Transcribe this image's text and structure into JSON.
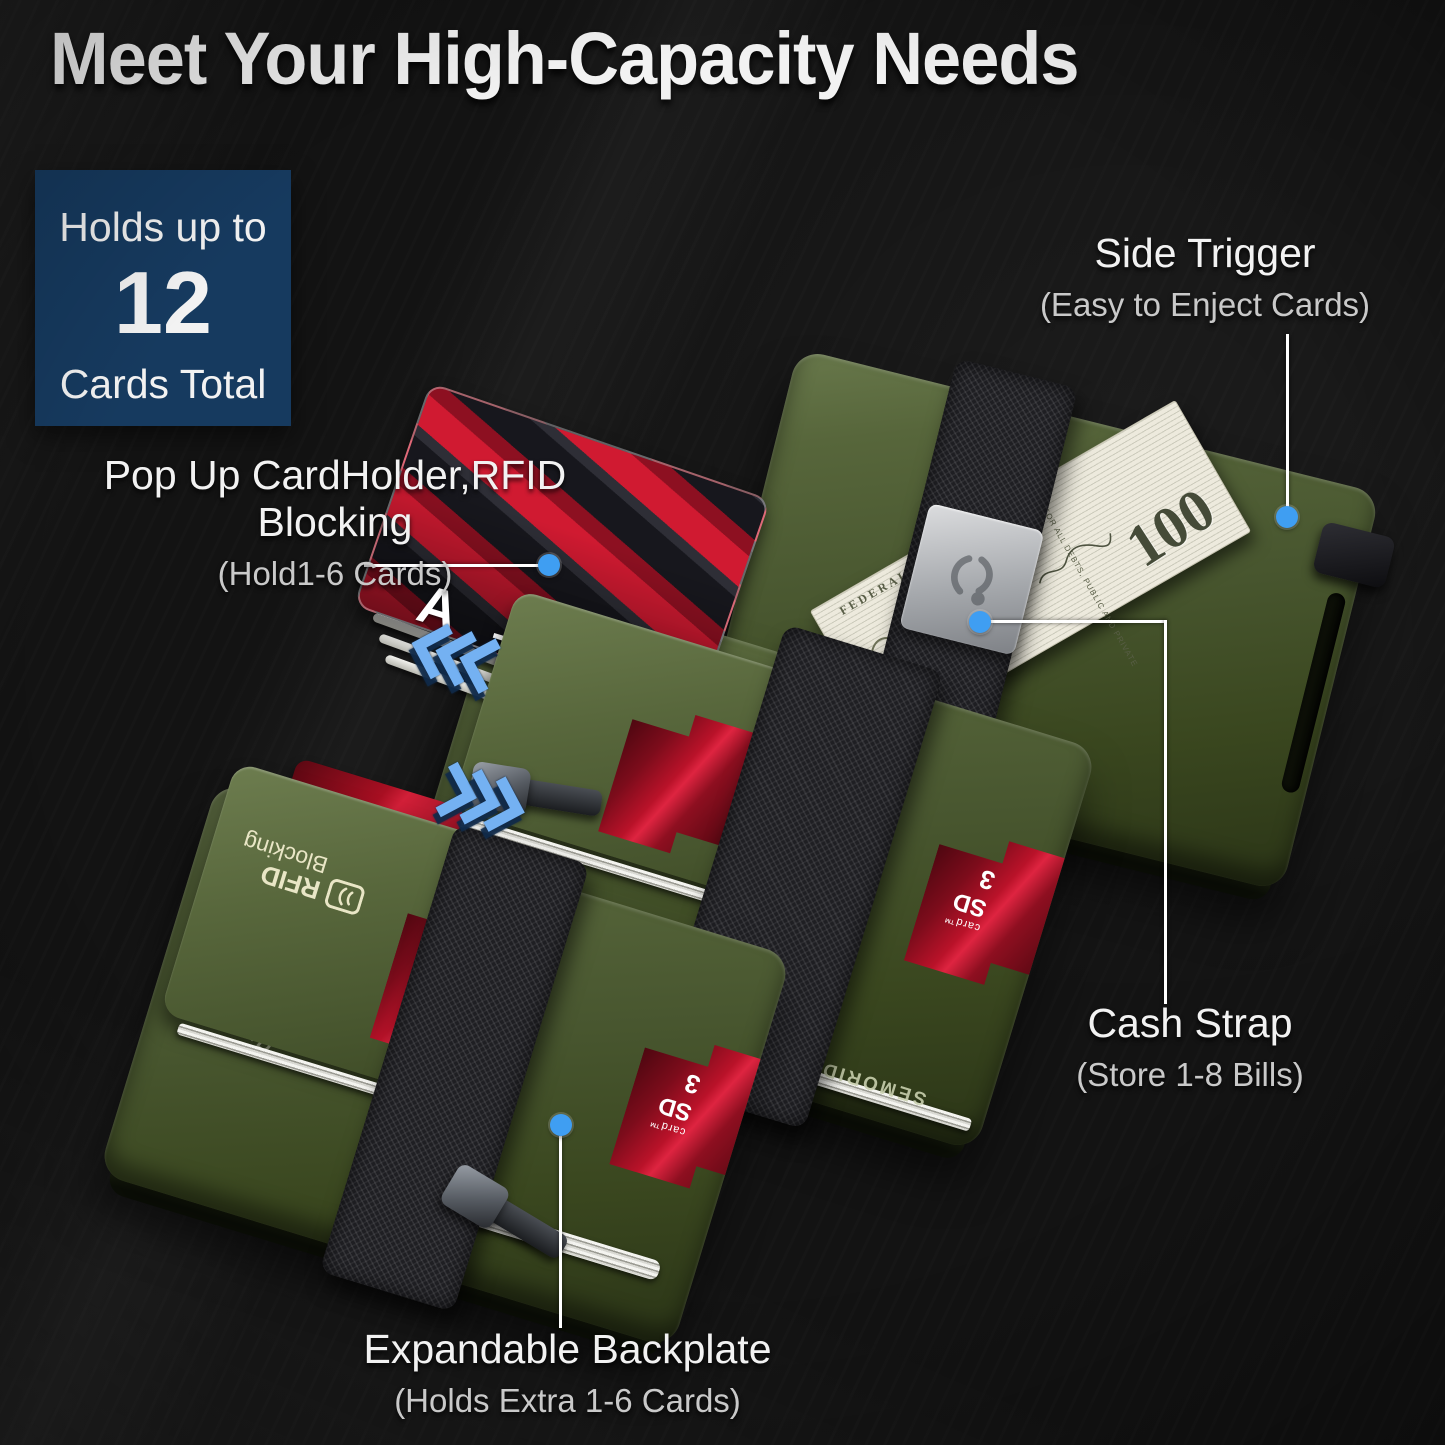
{
  "title": "Meet Your High-Capacity Needs",
  "badge": {
    "line1": "Holds up to",
    "number": "12",
    "line2": "Cards Total"
  },
  "callouts": {
    "popup": {
      "title": "Pop Up CardHolder,RFID Blocking",
      "subtitle": "(Hold1-6 Cards)"
    },
    "side_trigger": {
      "title": "Side Trigger",
      "subtitle": "(Easy to Enject Cards)"
    },
    "cash_strap": {
      "title": "Cash Strap",
      "subtitle": "(Store 1-8 Bills)"
    },
    "backplate": {
      "title": "Expandable Backplate",
      "subtitle": "(Holds Extra 1-6 Cards)"
    }
  },
  "product": {
    "brand": "SEMORID",
    "rfid_print": {
      "line1": "RFID",
      "line2": "Blocking"
    },
    "sd_card": {
      "suffix": "card",
      "brand": "SD",
      "tm": "™",
      "number": "3"
    },
    "bill": {
      "denomination": "100",
      "series_text": "FEDERAL RESERVE NOTE",
      "motto_text": "FOR ALL DEBTS, PUBLIC AND PRIVATE"
    },
    "fan_letters": [
      "A",
      "T",
      "A"
    ]
  },
  "colors": {
    "background": "#131313",
    "badge_bg": "#163a5f",
    "accent_blue": "#3f9ef2",
    "wallet_green": "#48562f",
    "card_red": "#b81227",
    "strap_black": "#1f1f23",
    "text_white": "#f2f2f2",
    "text_grey": "#c9c9c9"
  }
}
